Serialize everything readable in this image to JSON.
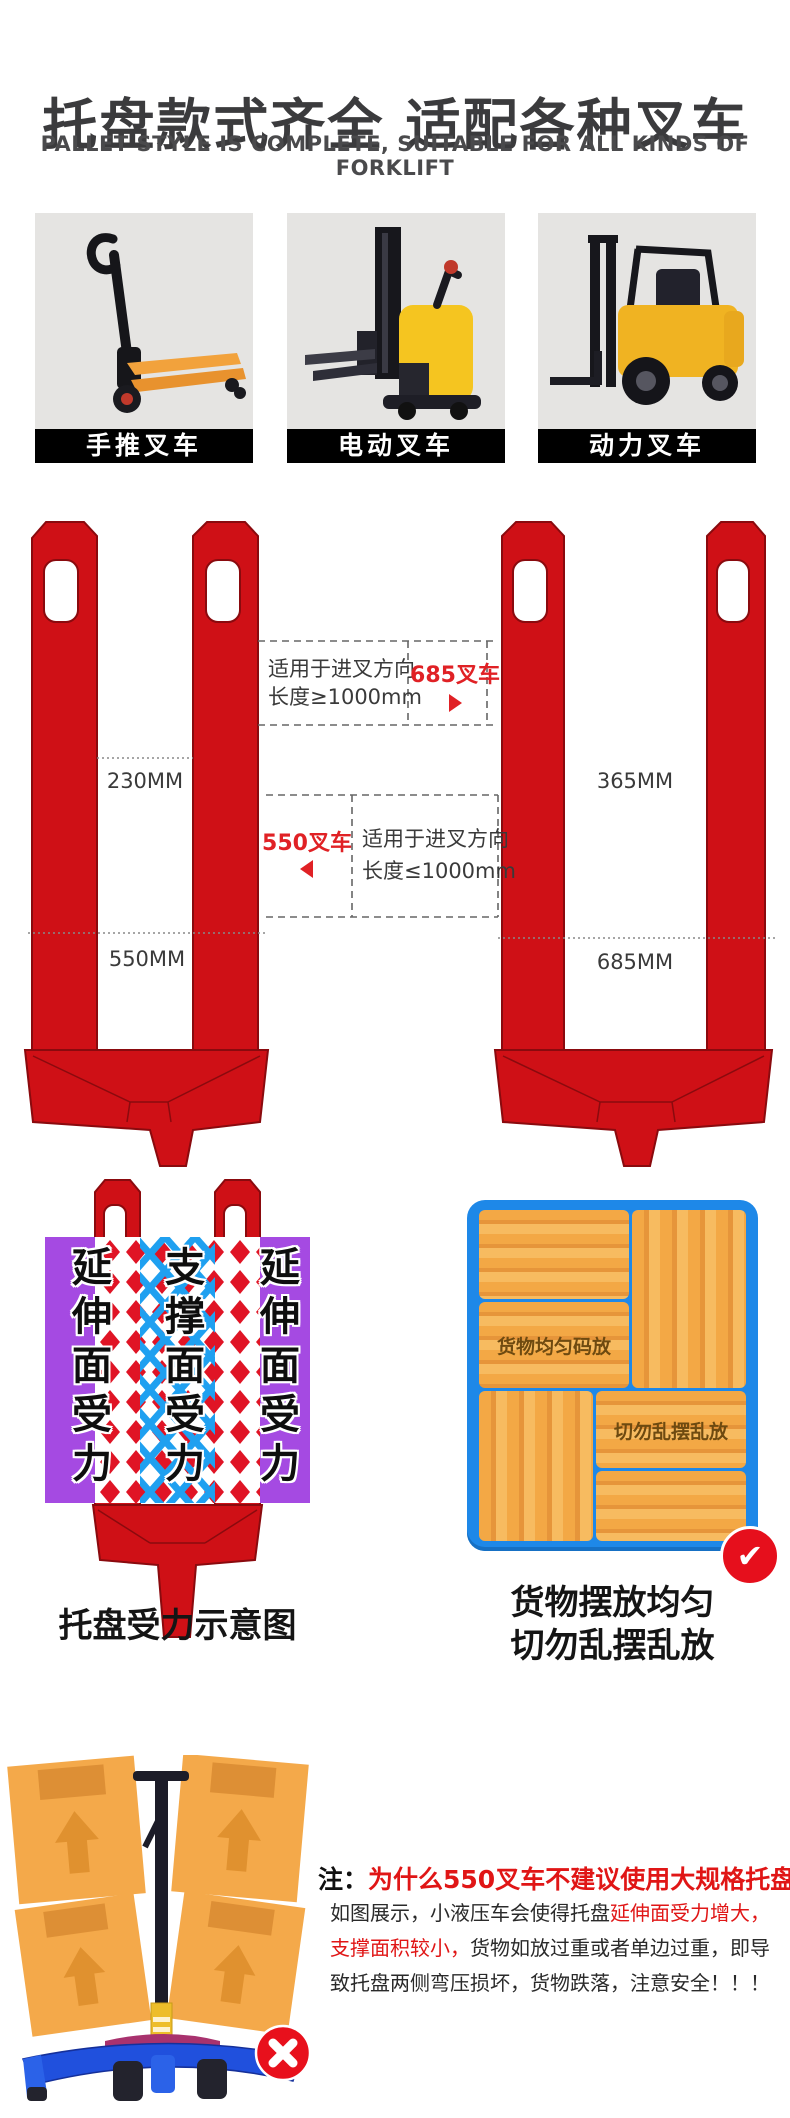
{
  "header": {
    "title": "托盘款式齐全 适配各种叉车",
    "subtitle": "PALLET STYLE IS COMPLETE, SUITABLE FOR ALL KINDS OF FORKLIFT"
  },
  "products": [
    {
      "label": "手推叉车",
      "icon": "hand-pallet-truck"
    },
    {
      "label": "电动叉车",
      "icon": "electric-stacker"
    },
    {
      "label": "动力叉车",
      "icon": "diesel-forklift"
    }
  ],
  "diagram": {
    "left_pallet": {
      "inner_width": "230MM",
      "outer_width": "550MM"
    },
    "right_pallet": {
      "inner_width": "365MM",
      "outer_width": "685MM"
    },
    "top_note": {
      "line1": "适用于进叉方向",
      "line2": "长度≥1000mm"
    },
    "bottom_note": {
      "line1": "适用于进叉方向",
      "line2": "长度≤1000mm"
    },
    "fork_685": "685叉车",
    "fork_550": "550叉车"
  },
  "stress": {
    "left": "延伸面受力",
    "center": "支撑面受力",
    "right": "延伸面受力",
    "caption": "托盘受力示意图"
  },
  "cargo": {
    "good": "货物均匀码放",
    "bad": "切勿乱摆乱放",
    "caption1": "货物摆放均匀",
    "caption2": "切勿乱摆乱放"
  },
  "note": {
    "prefix": "注：",
    "title": "为什么550叉车不建议使用大规格托盘",
    "p1_black": "如图展示，小液压车会使得托盘",
    "p1_red": "延伸面受力增大，",
    "p2_red": "支撑面积较小，",
    "p2_black": "货物如放过重或者单边过重，即导",
    "p3": "致托盘两侧弯压损坏，货物跌落，注意安全！！！"
  },
  "colors": {
    "pallet_red": "#cf1016",
    "accent_red": "#e02125",
    "purple": "#a54ae2",
    "pattern_blue": "#1fa0f0",
    "cargo_blue": "#1e88e8",
    "crate_orange": "#f3a845",
    "label_bar": "#000000"
  }
}
